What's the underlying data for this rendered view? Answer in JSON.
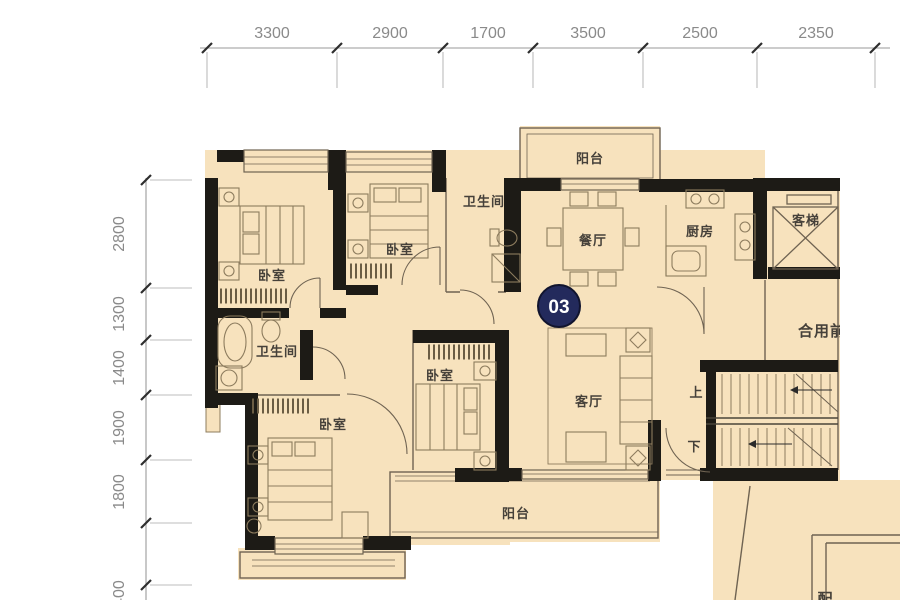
{
  "drawing": {
    "type": "floor-plan",
    "unit_number": "03"
  },
  "dimensions": {
    "top": [
      "3300",
      "2900",
      "1700",
      "3500",
      "2500",
      "2350"
    ],
    "left": [
      "2800",
      "1300",
      "1400",
      "1900",
      "1800",
      "1400"
    ]
  },
  "rooms": {
    "balcony_top": "阳台",
    "dining": "餐厅",
    "kitchen": "厨房",
    "elevator": "客梯",
    "bath_top": "卫生间",
    "bedroom_a": "卧室",
    "bedroom_b": "卧室",
    "bath_mid": "卫生间",
    "bedroom_c": "卧室",
    "bedroom_d": "卧室",
    "living": "客厅",
    "balcony_bottom": "阳台",
    "shared_lobby": "合用前",
    "stair_up": "上",
    "stair_down": "下",
    "partial_room": "配"
  },
  "colors": {
    "floor": "#f7e2bd",
    "wall": "#1d1b16",
    "furniture_line": "#8d7c5e",
    "thin_wall": "#6f6352",
    "dimension_text": "#8a8a8a",
    "badge": "#232a5c"
  }
}
